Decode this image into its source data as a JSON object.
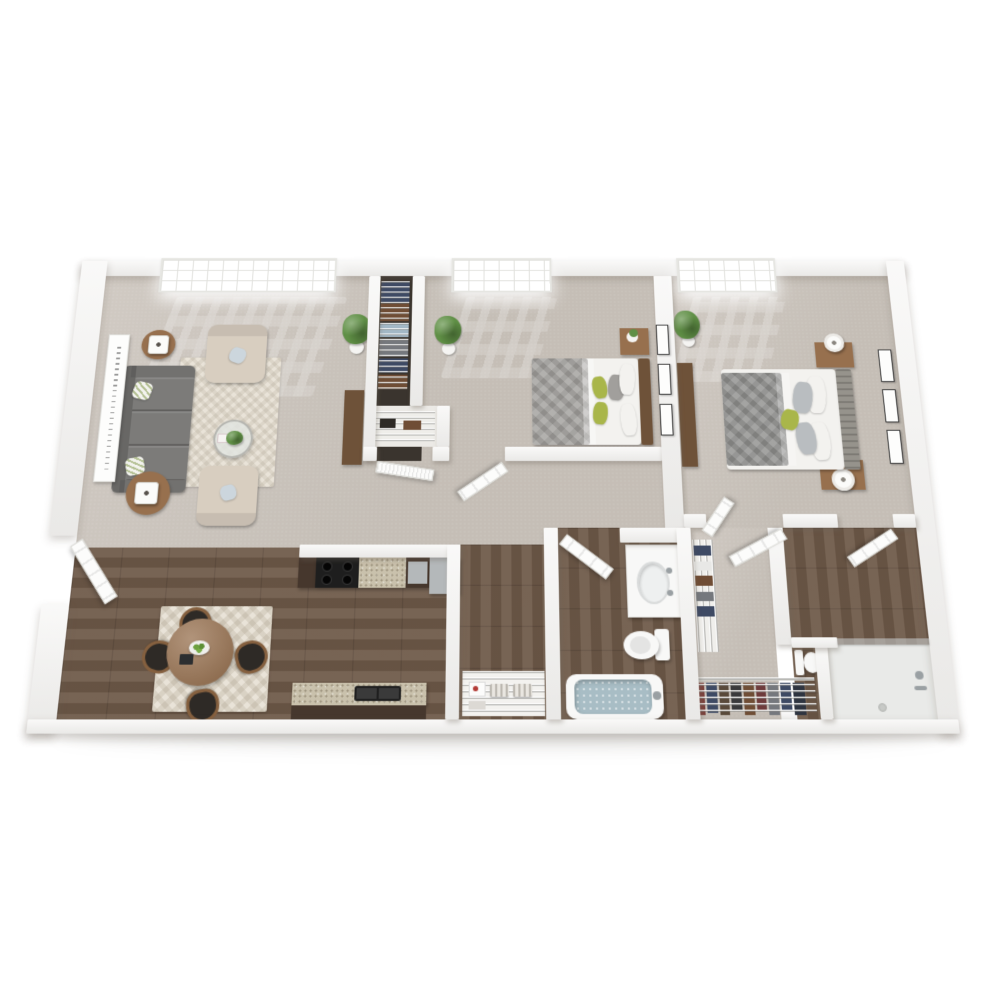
{
  "palette": {
    "background": "#ffffff",
    "wall": "#f3f2f0",
    "carpet": "#cbc4bc",
    "closet_floor": "#eceae6",
    "closet_dark": "#3a342e",
    "wood_floor": "#6f5a49",
    "shower_floor": "#e9eae8",
    "rug_cream": "#e9e3d8",
    "sofa_gray": "#7c7b79",
    "armchair_beige": "#d8cec0",
    "pillow_blue": "#ccd6dd",
    "accent_green": "#a9b64a",
    "plant_green": "#5f8f45",
    "wood_furniture": "#97704e",
    "wood_dark": "#6e5239",
    "cabinet_brown": "#46372d",
    "counter_granite": "#c9c1ac",
    "stove_black": "#1e1e1e",
    "stainless": "#b4b8ba",
    "bed_gray": "#a19f9c",
    "duvet2_gray": "#8f8f8d",
    "bed_white": "#f3f2ef",
    "headboard_gray": "#96938c",
    "tub_water": "#a8bdc5",
    "porcelain": "#f8f8f7",
    "door_white": "#fcfcfb",
    "window_white": "#ffffff",
    "art_frame": "#fdfdfc",
    "clothes_navy": "#3e4a64",
    "clothes_brown": "#6f4d35",
    "clothes_gray": "#75787d",
    "clothes_red": "#7c3f3a",
    "bin_blue": "#a3b8c6",
    "metal_gray": "#9aa0a3",
    "seat_black": "#2e2a26"
  },
  "rooms": [
    {
      "id": "living-room",
      "furniture": [
        "sofa",
        "armchair",
        "armchair",
        "end-table-lamp",
        "end-table-lamp",
        "coffee-table-plant",
        "area-rug",
        "wall-art",
        "console",
        "potted-plant",
        "window"
      ]
    },
    {
      "id": "dining-area",
      "furniture": [
        "round-dining-table",
        "four-chairs",
        "fruit-bowl",
        "area-rug",
        "front-door"
      ]
    },
    {
      "id": "kitchen",
      "furniture": [
        "cabinets",
        "range-stove",
        "granite-counter",
        "dishwasher",
        "refrigerator",
        "peninsula-double-sink"
      ]
    },
    {
      "id": "hall-closet",
      "furniture": [
        "wire-shelving",
        "hanging-clothes",
        "storage-bin",
        "wire-rack",
        "louvered-door"
      ]
    },
    {
      "id": "bedroom-1",
      "furniture": [
        "bed-green-pillows",
        "nightstand-plant",
        "wall-art",
        "potted-plant",
        "window",
        "door"
      ]
    },
    {
      "id": "bedroom-2",
      "furniture": [
        "bed-tufted-headboard",
        "nightstand-lamp",
        "nightstand-lamp",
        "dresser",
        "wall-art",
        "potted-plant",
        "window",
        "door"
      ]
    },
    {
      "id": "hallway",
      "furniture": [
        "linen-closet-wire-shelves",
        "baskets"
      ]
    },
    {
      "id": "bathroom",
      "furniture": [
        "vanity-sink",
        "toilet",
        "bathtub",
        "door"
      ]
    },
    {
      "id": "walk-in-closet",
      "furniture": [
        "wire-shelves",
        "hanging-clothes",
        "closet-door"
      ]
    },
    {
      "id": "second-bathroom",
      "furniture": [
        "toilet",
        "shower",
        "door"
      ]
    }
  ]
}
